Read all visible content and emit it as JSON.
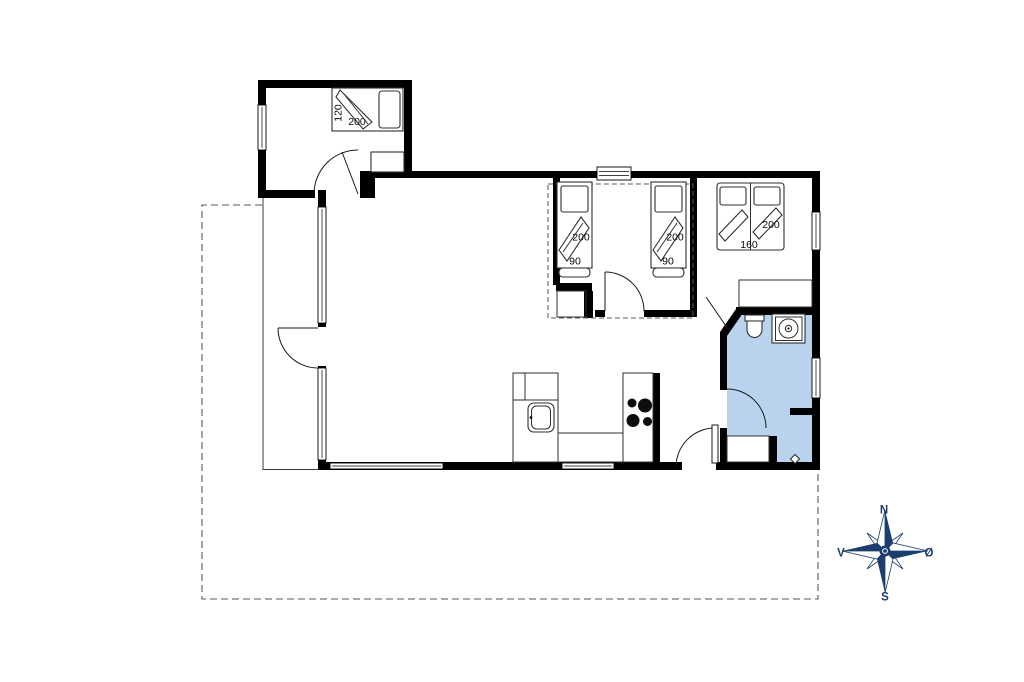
{
  "plan": {
    "bedroom_annex": {
      "bed_width": "120",
      "bed_length": "200"
    },
    "bedroom_twin": {
      "bed1_length": "200",
      "bed1_width": "90",
      "bed2_length": "200",
      "bed2_width": "90"
    },
    "bedroom_double": {
      "bed_length": "200",
      "bed_width": "160"
    }
  },
  "compass": {
    "north": "N",
    "south": "S",
    "east": "Ø",
    "west": "V"
  },
  "colors": {
    "wall": "#000000",
    "bathroom_fill": "#b9d3ee",
    "compass_navy": "#1c3e6e",
    "dash": "#5a5a5a"
  }
}
